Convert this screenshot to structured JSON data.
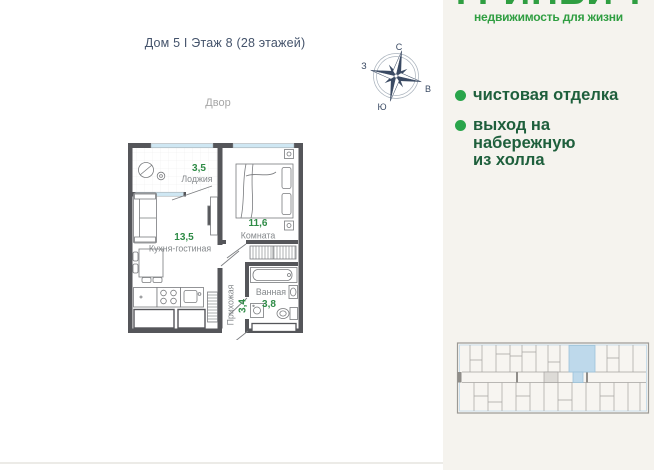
{
  "header": {
    "title": "Дом 5 I Этаж 8 (28 этажей)"
  },
  "plan": {
    "courtyard_label": "Двор",
    "rooms": {
      "loggia": {
        "name": "Лоджия",
        "area": "3,5"
      },
      "kitchen_living": {
        "name": "Кухня-гостиная",
        "area": "13,5"
      },
      "bedroom": {
        "name": "Комната",
        "area": "11,6"
      },
      "bathroom": {
        "name": "Ванная",
        "area": "3,8"
      },
      "hallway": {
        "name": "Прихожая",
        "area": "3,4"
      }
    }
  },
  "compass": {
    "north": "С",
    "south": "Ю",
    "west": "З",
    "east": "В"
  },
  "brand": {
    "name": "ГРИНВИЧ",
    "tagline": "недвижимость для жизни"
  },
  "features": {
    "finishing": "чистовая отделка",
    "embankment": "выход на\nнабережную\nиз холла"
  },
  "colors": {
    "brand_green": "#2f9e41",
    "bullet_green": "#29a54b",
    "feature_text_green": "#1e5f3c",
    "area_number_green": "#2e8b46",
    "wall_gray": "#55565a",
    "window_blue": "#cfe7f3",
    "minimap_highlight_blue": "#bed9eb",
    "header_navy": "#44536b",
    "panel_background": "#f5f3ee"
  }
}
